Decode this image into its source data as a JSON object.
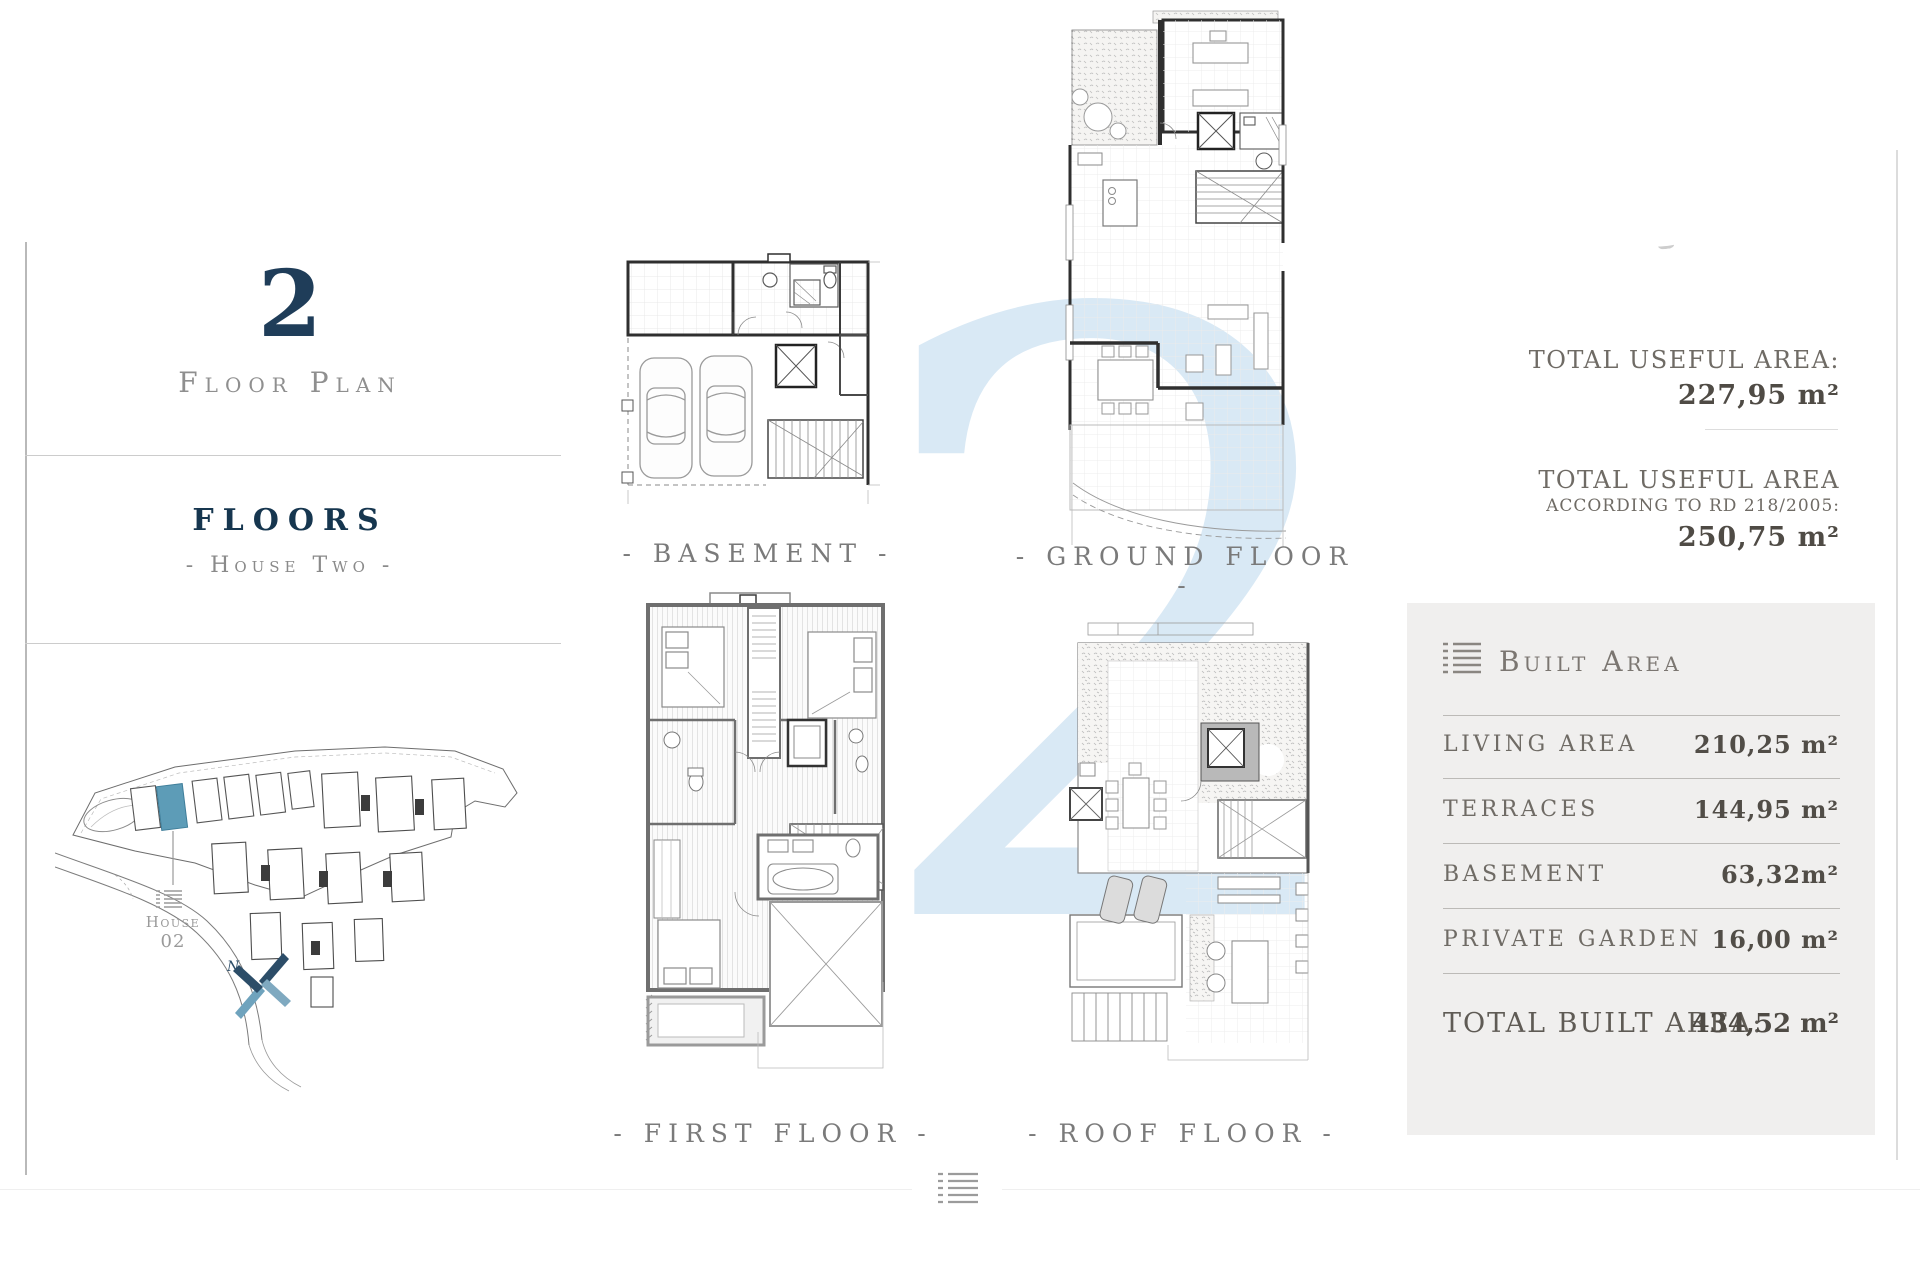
{
  "page": {
    "watermark": "2"
  },
  "sidebar": {
    "number": "2",
    "caption": "Floor Plan",
    "title": "FLOORS",
    "subtitle": "- House Two -",
    "site": {
      "house_line1": "House",
      "house_line2": "02",
      "compass_n": "N"
    }
  },
  "plans": {
    "basement": {
      "label": "- BASEMENT -"
    },
    "ground": {
      "label": "- GROUND FLOOR -"
    },
    "first": {
      "label": "- FIRST FLOOR -"
    },
    "roof": {
      "label": "- ROOF FLOOR -"
    }
  },
  "useful_area": {
    "label1": "TOTAL USEFUL AREA:",
    "value1": "227,95  m²",
    "label2": "TOTAL USEFUL AREA",
    "label2_sub": "ACCORDING TO RD 218/2005:",
    "value2": "250,75  m²"
  },
  "built_area": {
    "title": "Built Area",
    "rows": [
      {
        "label": "LIVING AREA",
        "value": "210,25 m²"
      },
      {
        "label": "TERRACES",
        "value": "144,95 m²"
      },
      {
        "label": "BASEMENT",
        "value": "63,32m²"
      },
      {
        "label": "PRIVATE GARDEN",
        "value": "16,00 m²"
      }
    ],
    "total_label": "TOTAL BUILT AREA:",
    "total_value": "434,52 m²"
  },
  "colors": {
    "accent_navy": "#1f3d59",
    "highlight_teal": "#5d9cb7",
    "watermark_blue": "#d9e9f5",
    "panel_bg": "#f0efee"
  }
}
